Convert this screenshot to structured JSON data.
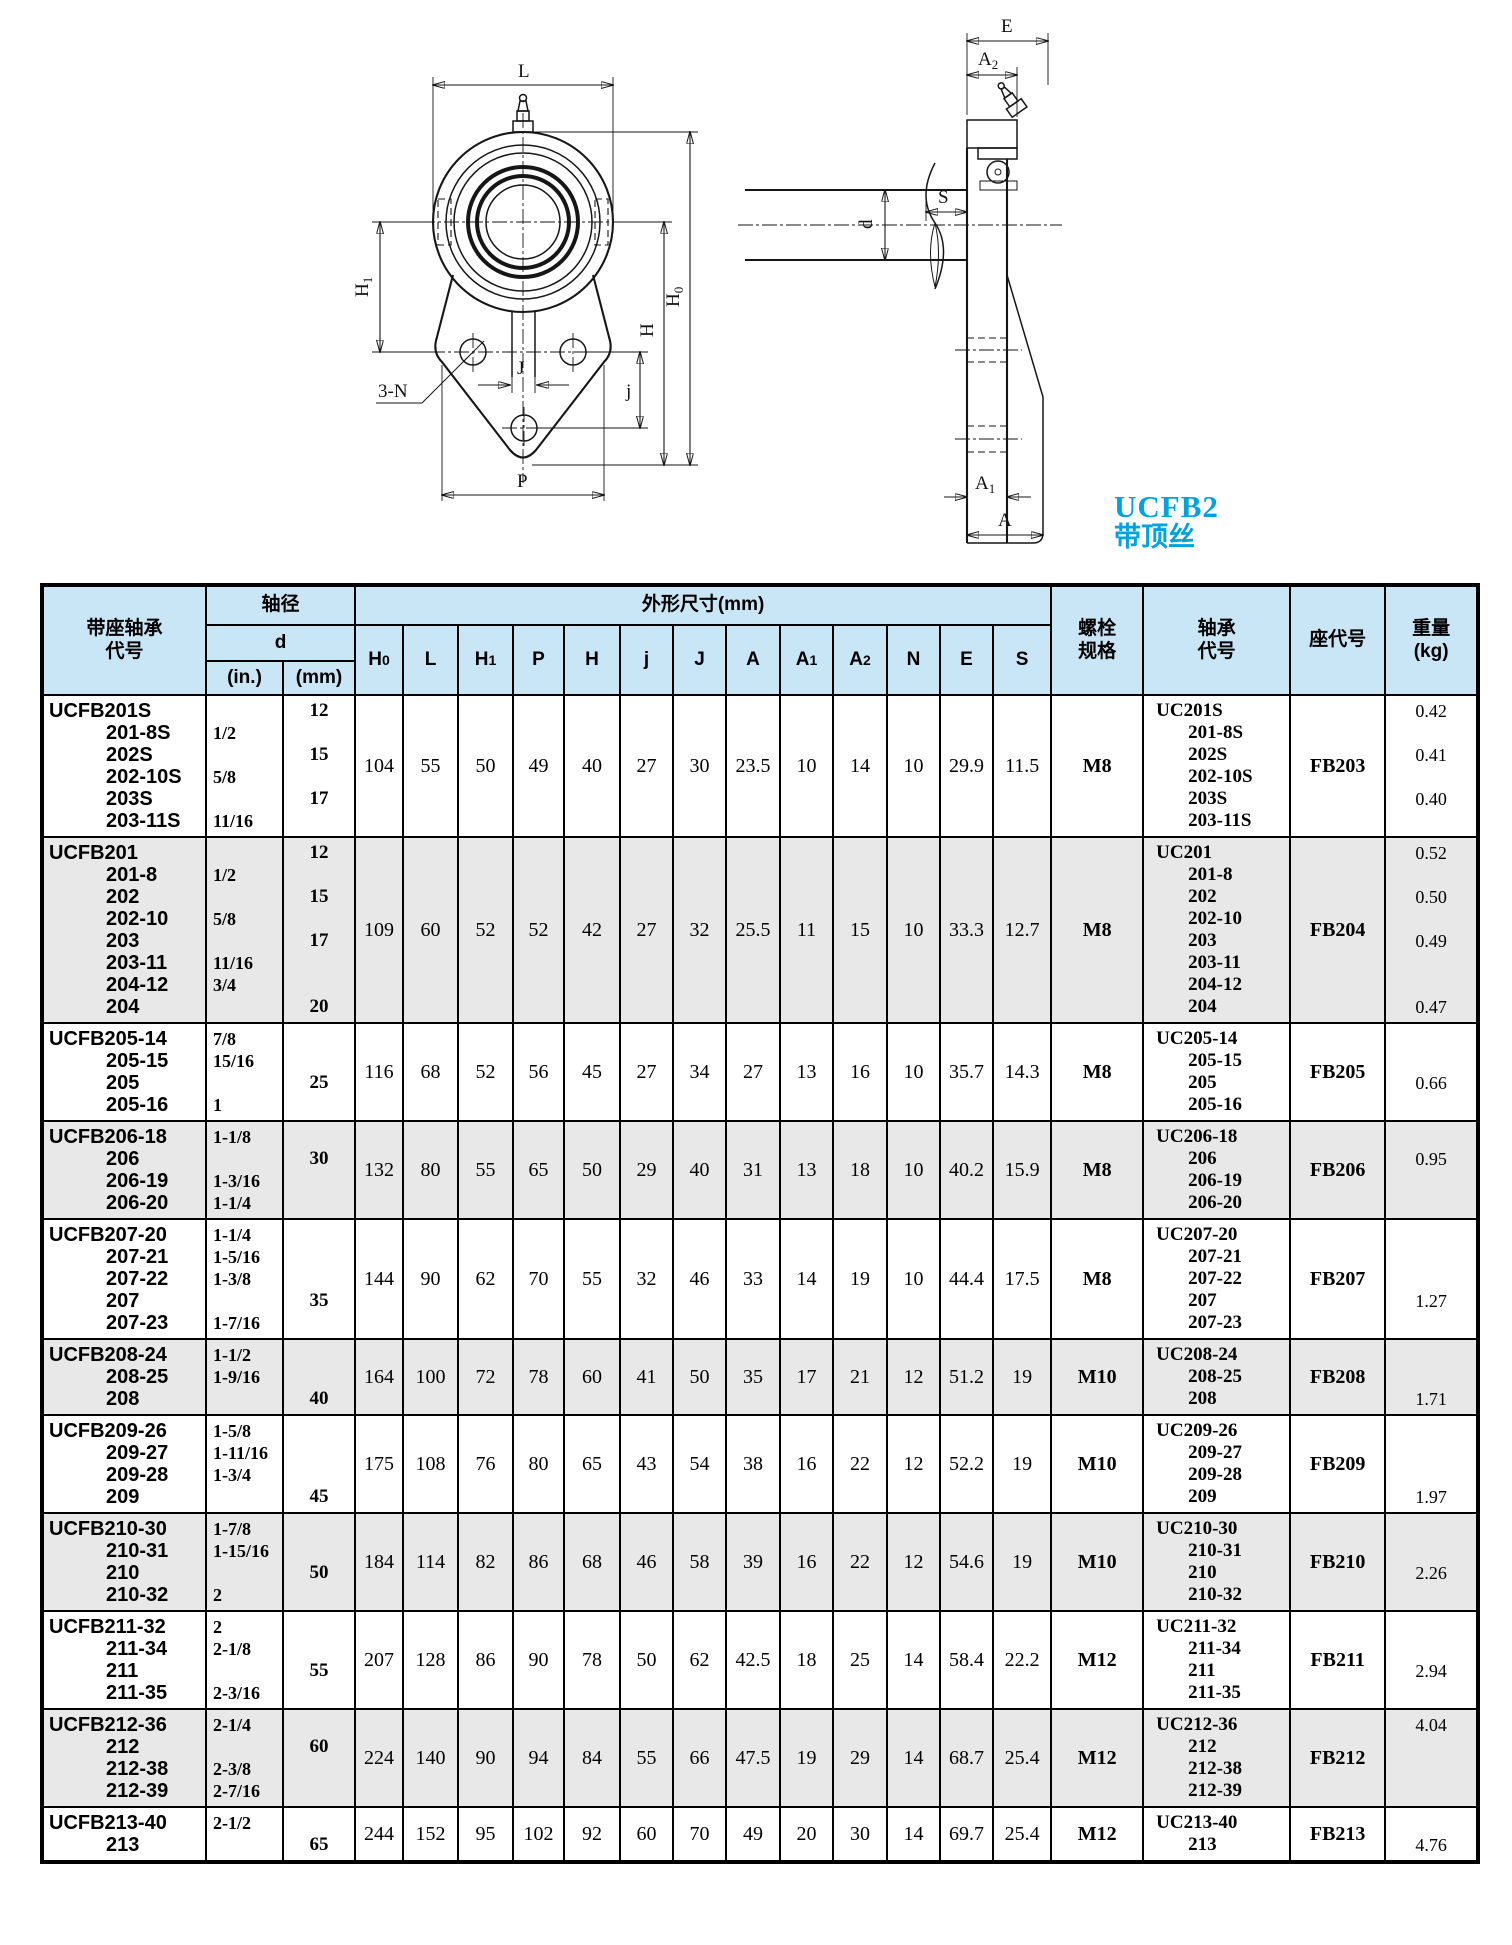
{
  "page": {
    "background": "#ffffff",
    "accent_color": "#00a2e0"
  },
  "series": {
    "code": "UCFB2",
    "note": "带顶丝"
  },
  "front_view": {
    "L": "L",
    "H1_main": "H",
    "H1_sub": "1",
    "H": "H",
    "H0_main": "H",
    "H0_sub": "0",
    "J": "J",
    "j": "j",
    "P": "P",
    "bolt_note": "3-N"
  },
  "side_view": {
    "E": "E",
    "A2_main": "A",
    "A2_sub": "2",
    "S": "S",
    "d": "d",
    "A1_main": "A",
    "A1_sub": "1",
    "A": "A"
  },
  "table": {
    "header": {
      "bearing_unit": "带座轴承\n代号",
      "shaft_dia": "轴径",
      "d": "d",
      "d_in": "(in.)",
      "d_mm": "(mm)",
      "dims_title": "外形尺寸(mm)",
      "dim_cols": [
        {
          "m": "H",
          "s": "0"
        },
        {
          "m": "L",
          "s": ""
        },
        {
          "m": "H",
          "s": "1"
        },
        {
          "m": "P",
          "s": ""
        },
        {
          "m": "H",
          "s": ""
        },
        {
          "m": "j",
          "s": ""
        },
        {
          "m": "J",
          "s": ""
        },
        {
          "m": "A",
          "s": ""
        },
        {
          "m": "A",
          "s": "1"
        },
        {
          "m": "A",
          "s": "2"
        },
        {
          "m": "N",
          "s": ""
        },
        {
          "m": "E",
          "s": ""
        },
        {
          "m": "S",
          "s": ""
        }
      ],
      "dim_keys": [
        "H0",
        "L",
        "H1",
        "P",
        "H",
        "j",
        "J",
        "A",
        "A1",
        "A2",
        "N",
        "E",
        "S"
      ],
      "bolt": "螺栓\n规格",
      "bearing_code": "轴承\n代号",
      "housing_code": "座代号",
      "weight": "重量\n(kg)"
    },
    "rows": [
      {
        "shade": false,
        "codes": [
          "UCFB201S",
          "201-8S",
          "202S",
          "202-10S",
          "203S",
          "203-11S"
        ],
        "d_in": [
          "",
          "1/2",
          "",
          "5/8",
          "",
          "11/16"
        ],
        "d_mm": [
          "12",
          "",
          "15",
          "",
          "17",
          ""
        ],
        "dims": [
          "104",
          "55",
          "50",
          "49",
          "40",
          "27",
          "30",
          "23.5",
          "10",
          "14",
          "10",
          "29.9",
          "11.5"
        ],
        "bolt": "M8",
        "bearing": [
          "UC201S",
          "201-8S",
          "202S",
          "202-10S",
          "203S",
          "203-11S"
        ],
        "housing": "FB203",
        "weights": [
          "0.42",
          "",
          "0.41",
          "",
          "0.40",
          ""
        ]
      },
      {
        "shade": true,
        "codes": [
          "UCFB201",
          "201-8",
          "202",
          "202-10",
          "203",
          "203-11",
          "204-12",
          "204"
        ],
        "d_in": [
          "",
          "1/2",
          "",
          "5/8",
          "",
          "11/16",
          "3/4",
          ""
        ],
        "d_mm": [
          "12",
          "",
          "15",
          "",
          "17",
          "",
          "",
          "20"
        ],
        "dims": [
          "109",
          "60",
          "52",
          "52",
          "42",
          "27",
          "32",
          "25.5",
          "11",
          "15",
          "10",
          "33.3",
          "12.7"
        ],
        "bolt": "M8",
        "bearing": [
          "UC201",
          "201-8",
          "202",
          "202-10",
          "203",
          "203-11",
          "204-12",
          "204"
        ],
        "housing": "FB204",
        "weights": [
          "0.52",
          "",
          "0.50",
          "",
          "0.49",
          "",
          "",
          "0.47"
        ]
      },
      {
        "shade": false,
        "codes": [
          "UCFB205-14",
          "205-15",
          "205",
          "205-16"
        ],
        "d_in": [
          "7/8",
          "15/16",
          "",
          "1"
        ],
        "d_mm": [
          "",
          "",
          "25",
          ""
        ],
        "dims": [
          "116",
          "68",
          "52",
          "56",
          "45",
          "27",
          "34",
          "27",
          "13",
          "16",
          "10",
          "35.7",
          "14.3"
        ],
        "bolt": "M8",
        "bearing": [
          "UC205-14",
          "205-15",
          "205",
          "205-16"
        ],
        "housing": "FB205",
        "weights": [
          "",
          "",
          "0.66",
          ""
        ]
      },
      {
        "shade": true,
        "codes": [
          "UCFB206-18",
          "206",
          "206-19",
          "206-20"
        ],
        "d_in": [
          "1-1/8",
          "",
          "1-3/16",
          "1-1/4"
        ],
        "d_mm": [
          "",
          "30",
          "",
          ""
        ],
        "dims": [
          "132",
          "80",
          "55",
          "65",
          "50",
          "29",
          "40",
          "31",
          "13",
          "18",
          "10",
          "40.2",
          "15.9"
        ],
        "bolt": "M8",
        "bearing": [
          "UC206-18",
          "206",
          "206-19",
          "206-20"
        ],
        "housing": "FB206",
        "weights": [
          "",
          "0.95",
          "",
          ""
        ]
      },
      {
        "shade": false,
        "codes": [
          "UCFB207-20",
          "207-21",
          "207-22",
          "207",
          "207-23"
        ],
        "d_in": [
          "1-1/4",
          "1-5/16",
          "1-3/8",
          "",
          "1-7/16"
        ],
        "d_mm": [
          "",
          "",
          "",
          "35",
          ""
        ],
        "dims": [
          "144",
          "90",
          "62",
          "70",
          "55",
          "32",
          "46",
          "33",
          "14",
          "19",
          "10",
          "44.4",
          "17.5"
        ],
        "bolt": "M8",
        "bearing": [
          "UC207-20",
          "207-21",
          "207-22",
          "207",
          "207-23"
        ],
        "housing": "FB207",
        "weights": [
          "",
          "",
          "",
          "1.27",
          ""
        ]
      },
      {
        "shade": true,
        "codes": [
          "UCFB208-24",
          "208-25",
          "208"
        ],
        "d_in": [
          "1-1/2",
          "1-9/16",
          ""
        ],
        "d_mm": [
          "",
          "",
          "40"
        ],
        "dims": [
          "164",
          "100",
          "72",
          "78",
          "60",
          "41",
          "50",
          "35",
          "17",
          "21",
          "12",
          "51.2",
          "19"
        ],
        "bolt": "M10",
        "bearing": [
          "UC208-24",
          "208-25",
          "208"
        ],
        "housing": "FB208",
        "weights": [
          "",
          "",
          "1.71"
        ]
      },
      {
        "shade": false,
        "codes": [
          "UCFB209-26",
          "209-27",
          "209-28",
          "209"
        ],
        "d_in": [
          "1-5/8",
          "1-11/16",
          "1-3/4",
          ""
        ],
        "d_mm": [
          "",
          "",
          "",
          "45"
        ],
        "dims": [
          "175",
          "108",
          "76",
          "80",
          "65",
          "43",
          "54",
          "38",
          "16",
          "22",
          "12",
          "52.2",
          "19"
        ],
        "bolt": "M10",
        "bearing": [
          "UC209-26",
          "209-27",
          "209-28",
          "209"
        ],
        "housing": "FB209",
        "weights": [
          "",
          "",
          "",
          "1.97"
        ]
      },
      {
        "shade": true,
        "codes": [
          "UCFB210-30",
          "210-31",
          "210",
          "210-32"
        ],
        "d_in": [
          "1-7/8",
          "1-15/16",
          "",
          "2"
        ],
        "d_mm": [
          "",
          "",
          "50",
          ""
        ],
        "dims": [
          "184",
          "114",
          "82",
          "86",
          "68",
          "46",
          "58",
          "39",
          "16",
          "22",
          "12",
          "54.6",
          "19"
        ],
        "bolt": "M10",
        "bearing": [
          "UC210-30",
          "210-31",
          "210",
          "210-32"
        ],
        "housing": "FB210",
        "weights": [
          "",
          "",
          "2.26",
          ""
        ]
      },
      {
        "shade": false,
        "codes": [
          "UCFB211-32",
          "211-34",
          "211",
          "211-35"
        ],
        "d_in": [
          "2",
          "2-1/8",
          "",
          "2-3/16"
        ],
        "d_mm": [
          "",
          "",
          "55",
          ""
        ],
        "dims": [
          "207",
          "128",
          "86",
          "90",
          "78",
          "50",
          "62",
          "42.5",
          "18",
          "25",
          "14",
          "58.4",
          "22.2"
        ],
        "bolt": "M12",
        "bearing": [
          "UC211-32",
          "211-34",
          "211",
          "211-35"
        ],
        "housing": "FB211",
        "weights": [
          "",
          "",
          "2.94",
          ""
        ]
      },
      {
        "shade": true,
        "codes": [
          "UCFB212-36",
          "212",
          "212-38",
          "212-39"
        ],
        "d_in": [
          "2-1/4",
          "",
          "2-3/8",
          "2-7/16"
        ],
        "d_mm": [
          "",
          "60",
          "",
          ""
        ],
        "dims": [
          "224",
          "140",
          "90",
          "94",
          "84",
          "55",
          "66",
          "47.5",
          "19",
          "29",
          "14",
          "68.7",
          "25.4"
        ],
        "bolt": "M12",
        "bearing": [
          "UC212-36",
          "212",
          "212-38",
          "212-39"
        ],
        "housing": "FB212",
        "weights": [
          "4.04",
          "",
          "",
          ""
        ]
      },
      {
        "shade": false,
        "codes": [
          "UCFB213-40",
          "213"
        ],
        "d_in": [
          "2-1/2",
          ""
        ],
        "d_mm": [
          "",
          "65"
        ],
        "dims": [
          "244",
          "152",
          "95",
          "102",
          "92",
          "60",
          "70",
          "49",
          "20",
          "30",
          "14",
          "69.7",
          "25.4"
        ],
        "bolt": "M12",
        "bearing": [
          "UC213-40",
          "213"
        ],
        "housing": "FB213",
        "weights": [
          "",
          "4.76"
        ]
      }
    ]
  }
}
